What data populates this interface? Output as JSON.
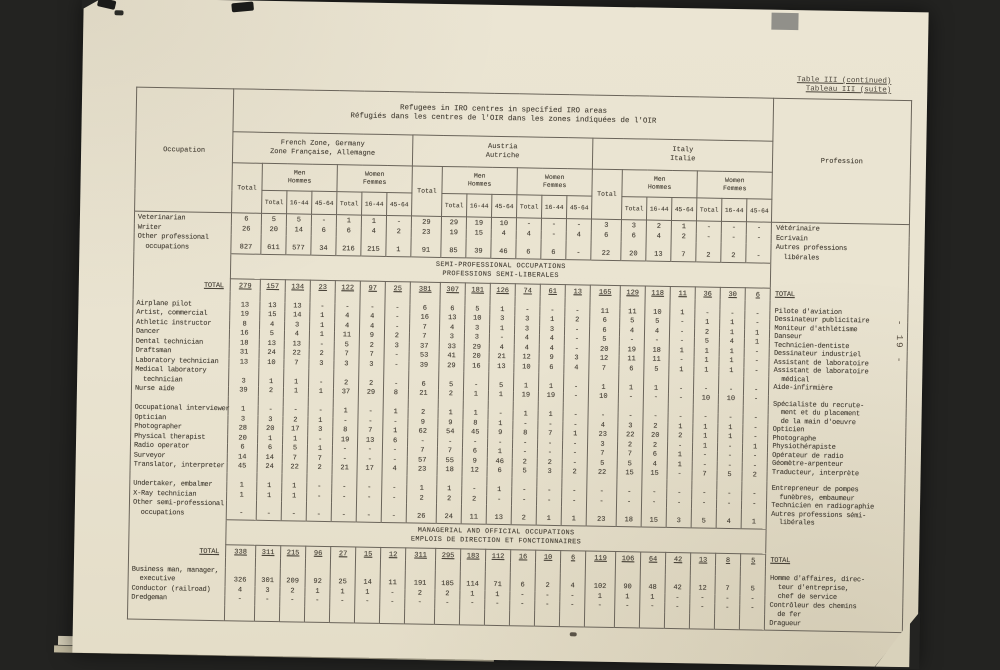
{
  "meta": {
    "ref_line1": "Table III (continued)",
    "ref_line2": "Tableau III (suite)",
    "page_number": "- 19 -"
  },
  "table": {
    "title_line1": "Refugees in IRO centres in specified IRO areas",
    "title_line2": "Réfugiés dans les centres de l'OIR dans les zones indiquées de l'OIR",
    "occupation_header": "Occupation",
    "profession_header": "Profession",
    "total_label": "Total",
    "age_headers": [
      "Total",
      "16-44",
      "45-64"
    ],
    "zones": [
      {
        "en": "French Zone, Germany",
        "fr": "Zone Française, Allemagne"
      },
      {
        "en": "Austria",
        "fr": "Autriche"
      },
      {
        "en": "Italy",
        "fr": "Italie"
      }
    ],
    "sex_groups": [
      {
        "en": "Men",
        "fr": "Hommes"
      },
      {
        "en": "Women",
        "fr": "Femmes"
      }
    ],
    "sections": [
      {
        "band": null,
        "french_lines": [
          "Vétérinaire",
          "Ecrivain",
          "Autres professions",
          "  libérales"
        ],
        "rows": [
          {
            "label": "Veterinarian",
            "values": [
              "6",
              "5",
              "5",
              "-",
              "1",
              "1",
              "-",
              "29",
              "29",
              "19",
              "10",
              "-",
              "-",
              "-",
              "3",
              "3",
              "2",
              "1",
              "-",
              "-",
              "-"
            ]
          },
          {
            "label": "Writer",
            "values": [
              "26",
              "20",
              "14",
              "6",
              "6",
              "4",
              "2",
              "23",
              "19",
              "15",
              "4",
              "4",
              "-",
              "4",
              "6",
              "6",
              "4",
              "2",
              "-",
              "-",
              "-"
            ]
          },
          {
            "label": "Other professional\n  occupations",
            "values": [
              "827",
              "611",
              "577",
              "34",
              "216",
              "215",
              "1",
              "91",
              "85",
              "39",
              "46",
              "6",
              "6",
              "-",
              "22",
              "20",
              "13",
              "7",
              "2",
              "2",
              "-"
            ]
          }
        ]
      },
      {
        "band": {
          "en": "SEMI-PROFESSIONAL OCCUPATIONS",
          "fr": "PROFESSIONS SEMI-LIBERALES"
        },
        "french_lines": [
          "TOTAL",
          "",
          "Pilote d'aviation",
          "Dessinateur publicitaire",
          "Moniteur d'athlétisme",
          "Danseur",
          "Technicien-dentiste",
          "Dessinateur industriel",
          "Assistant de laboratoire",
          "Assistant de laboratoire",
          "  médical",
          "Aide-infirmière",
          "",
          "Spécialiste du recrute-",
          "  ment et du placement",
          "  de la main d'oeuvre",
          "Opticien",
          "Photographe",
          "Physiothérapiste",
          "Opérateur de radio",
          "Géomètre-arpenteur",
          "Traducteur, interprète",
          "",
          "Entrepreneur de pompes",
          "  funèbres, embaumeur",
          "Technicien en radiographie",
          "Autres professions sémi-",
          "  libérales"
        ],
        "rows": [
          {
            "label": "TOTAL",
            "style": "total",
            "values": [
              "279",
              "157",
              "134",
              "23",
              "122",
              "97",
              "25",
              "381",
              "307",
              "181",
              "126",
              "74",
              "61",
              "13",
              "165",
              "129",
              "118",
              "11",
              "36",
              "30",
              "6"
            ]
          },
          {
            "spacer": true
          },
          {
            "label": "Airplane pilot",
            "values": [
              "13",
              "13",
              "13",
              "-",
              "-",
              "-",
              "-",
              "6",
              "6",
              "5",
              "1",
              "-",
              "-",
              "-",
              "11",
              "11",
              "10",
              "1",
              "-",
              "-",
              "-"
            ]
          },
          {
            "label": "Artist, commercial",
            "values": [
              "19",
              "15",
              "14",
              "1",
              "4",
              "4",
              "-",
              "16",
              "13",
              "10",
              "3",
              "3",
              "1",
              "2",
              "6",
              "5",
              "5",
              "-",
              "1",
              "1",
              "-"
            ]
          },
          {
            "label": "Athletic instructor",
            "values": [
              "8",
              "4",
              "3",
              "1",
              "4",
              "4",
              "-",
              "7",
              "4",
              "3",
              "1",
              "3",
              "3",
              "-",
              "6",
              "4",
              "4",
              "-",
              "2",
              "1",
              "1"
            ]
          },
          {
            "label": "Dancer",
            "values": [
              "16",
              "5",
              "4",
              "1",
              "11",
              "9",
              "2",
              "7",
              "3",
              "3",
              "-",
              "4",
              "4",
              "-",
              "5",
              "-",
              "-",
              "-",
              "5",
              "4",
              "1"
            ]
          },
          {
            "label": "Dental technician",
            "values": [
              "18",
              "13",
              "13",
              "-",
              "5",
              "2",
              "3",
              "37",
              "33",
              "29",
              "4",
              "4",
              "4",
              "-",
              "20",
              "19",
              "18",
              "1",
              "1",
              "1",
              "-"
            ]
          },
          {
            "label": "Draftsman",
            "values": [
              "31",
              "24",
              "22",
              "2",
              "7",
              "7",
              "-",
              "53",
              "41",
              "20",
              "21",
              "12",
              "9",
              "3",
              "12",
              "11",
              "11",
              "-",
              "1",
              "1",
              "-"
            ]
          },
          {
            "label": "Laboratory technician",
            "values": [
              "13",
              "10",
              "7",
              "3",
              "3",
              "3",
              "-",
              "39",
              "29",
              "16",
              "13",
              "10",
              "6",
              "4",
              "7",
              "6",
              "5",
              "1",
              "1",
              "1",
              "-"
            ]
          },
          {
            "label": "Medical laboratory\n  technician",
            "values": [
              "3",
              "1",
              "1",
              "-",
              "2",
              "2",
              "-",
              "6",
              "5",
              "-",
              "5",
              "1",
              "1",
              "-",
              "1",
              "1",
              "1",
              "-",
              "-",
              "-",
              "-"
            ]
          },
          {
            "label": "Nurse aide",
            "values": [
              "39",
              "2",
              "1",
              "1",
              "37",
              "29",
              "8",
              "21",
              "2",
              "1",
              "1",
              "19",
              "19",
              "-",
              "10",
              "-",
              "-",
              "-",
              "10",
              "10",
              "-"
            ]
          },
          {
            "spacer": true
          },
          {
            "label": "Occupational interviewer",
            "values": [
              "1",
              "-",
              "-",
              "-",
              "1",
              "-",
              "1",
              "2",
              "1",
              "1",
              "-",
              "1",
              "1",
              "-",
              "-",
              "-",
              "-",
              "-",
              "-",
              "-",
              "-"
            ]
          },
          {
            "label": "Optician",
            "values": [
              "3",
              "3",
              "2",
              "1",
              "-",
              "-",
              "-",
              "9",
              "9",
              "8",
              "1",
              "-",
              "-",
              "-",
              "4",
              "3",
              "2",
              "1",
              "1",
              "1",
              "-"
            ]
          },
          {
            "label": "Photographer",
            "values": [
              "28",
              "20",
              "17",
              "3",
              "8",
              "7",
              "1",
              "62",
              "54",
              "45",
              "9",
              "8",
              "7",
              "1",
              "23",
              "22",
              "20",
              "2",
              "1",
              "1",
              "-"
            ]
          },
          {
            "label": "Physical therapist",
            "values": [
              "20",
              "1",
              "1",
              "-",
              "19",
              "13",
              "6",
              "-",
              "-",
              "-",
              "-",
              "-",
              "-",
              "-",
              "3",
              "2",
              "2",
              "-",
              "1",
              "-",
              "1"
            ]
          },
          {
            "label": "Radio operator",
            "values": [
              "6",
              "6",
              "5",
              "1",
              "-",
              "-",
              "-",
              "7",
              "7",
              "6",
              "1",
              "-",
              "-",
              "-",
              "7",
              "7",
              "6",
              "1",
              "-",
              "-",
              "-"
            ]
          },
          {
            "label": "Surveyor",
            "values": [
              "14",
              "14",
              "7",
              "7",
              "-",
              "-",
              "-",
              "57",
              "55",
              "9",
              "46",
              "2",
              "2",
              "-",
              "5",
              "5",
              "4",
              "1",
              "-",
              "-",
              "-"
            ]
          },
          {
            "label": "Translator, interpreter",
            "values": [
              "45",
              "24",
              "22",
              "2",
              "21",
              "17",
              "4",
              "23",
              "18",
              "12",
              "6",
              "5",
              "3",
              "2",
              "22",
              "15",
              "15",
              "-",
              "7",
              "5",
              "2"
            ]
          },
          {
            "spacer": true
          },
          {
            "label": "Undertaker, embalmer",
            "values": [
              "1",
              "1",
              "1",
              "-",
              "-",
              "-",
              "-",
              "1",
              "1",
              "-",
              "1",
              "-",
              "-",
              "-",
              "-",
              "-",
              "-",
              "-",
              "-",
              "-",
              "-"
            ]
          },
          {
            "label": "X-Ray technician",
            "values": [
              "1",
              "1",
              "1",
              "-",
              "-",
              "-",
              "-",
              "2",
              "2",
              "2",
              "-",
              "-",
              "-",
              "-",
              "-",
              "-",
              "-",
              "-",
              "-",
              "-",
              "-"
            ]
          },
          {
            "label": "Other semi-professional\n  occupations",
            "values": [
              "-",
              "-",
              "-",
              "-",
              "-",
              "-",
              "-",
              "26",
              "24",
              "11",
              "13",
              "2",
              "1",
              "1",
              "23",
              "18",
              "15",
              "3",
              "5",
              "4",
              "1"
            ]
          }
        ]
      },
      {
        "band": {
          "en": "MANAGERIAL AND OFFICIAL OCCUPATIONS",
          "fr": "EMPLOIS DE DIRECTION ET FONCTIONNAIRES"
        },
        "french_lines": [
          "TOTAL",
          "",
          "Homme d'affaires, direc-",
          "  teur d'entreprise,",
          "  chef de service",
          "Contrôleur des chemins",
          "  de fer",
          "Dragueur"
        ],
        "rows": [
          {
            "label": "TOTAL",
            "style": "total",
            "values": [
              "338",
              "311",
              "215",
              "96",
              "27",
              "15",
              "12",
              "311",
              "295",
              "183",
              "112",
              "16",
              "10",
              "6",
              "119",
              "106",
              "64",
              "42",
              "13",
              "8",
              "5"
            ]
          },
          {
            "spacer": true
          },
          {
            "label": "Business man, manager,\n  executive",
            "values": [
              "326",
              "301",
              "209",
              "92",
              "25",
              "14",
              "11",
              "191",
              "185",
              "114",
              "71",
              "6",
              "2",
              "4",
              "102",
              "90",
              "48",
              "42",
              "12",
              "7",
              "5"
            ]
          },
          {
            "label": "Conductor (railroad)",
            "values": [
              "4",
              "3",
              "2",
              "1",
              "1",
              "1",
              "-",
              "2",
              "2",
              "1",
              "1",
              "-",
              "-",
              "-",
              "1",
              "1",
              "1",
              "-",
              "-",
              "-",
              "-"
            ]
          },
          {
            "label": "Dredgeman",
            "values": [
              "-",
              "-",
              "-",
              "-",
              "-",
              "-",
              "-",
              "-",
              "-",
              "-",
              "-",
              "-",
              "-",
              "-",
              "-",
              "-",
              "-",
              "-",
              "-",
              "-",
              "-"
            ]
          },
          {
            "spacer": true,
            "h": 16
          }
        ]
      }
    ]
  }
}
